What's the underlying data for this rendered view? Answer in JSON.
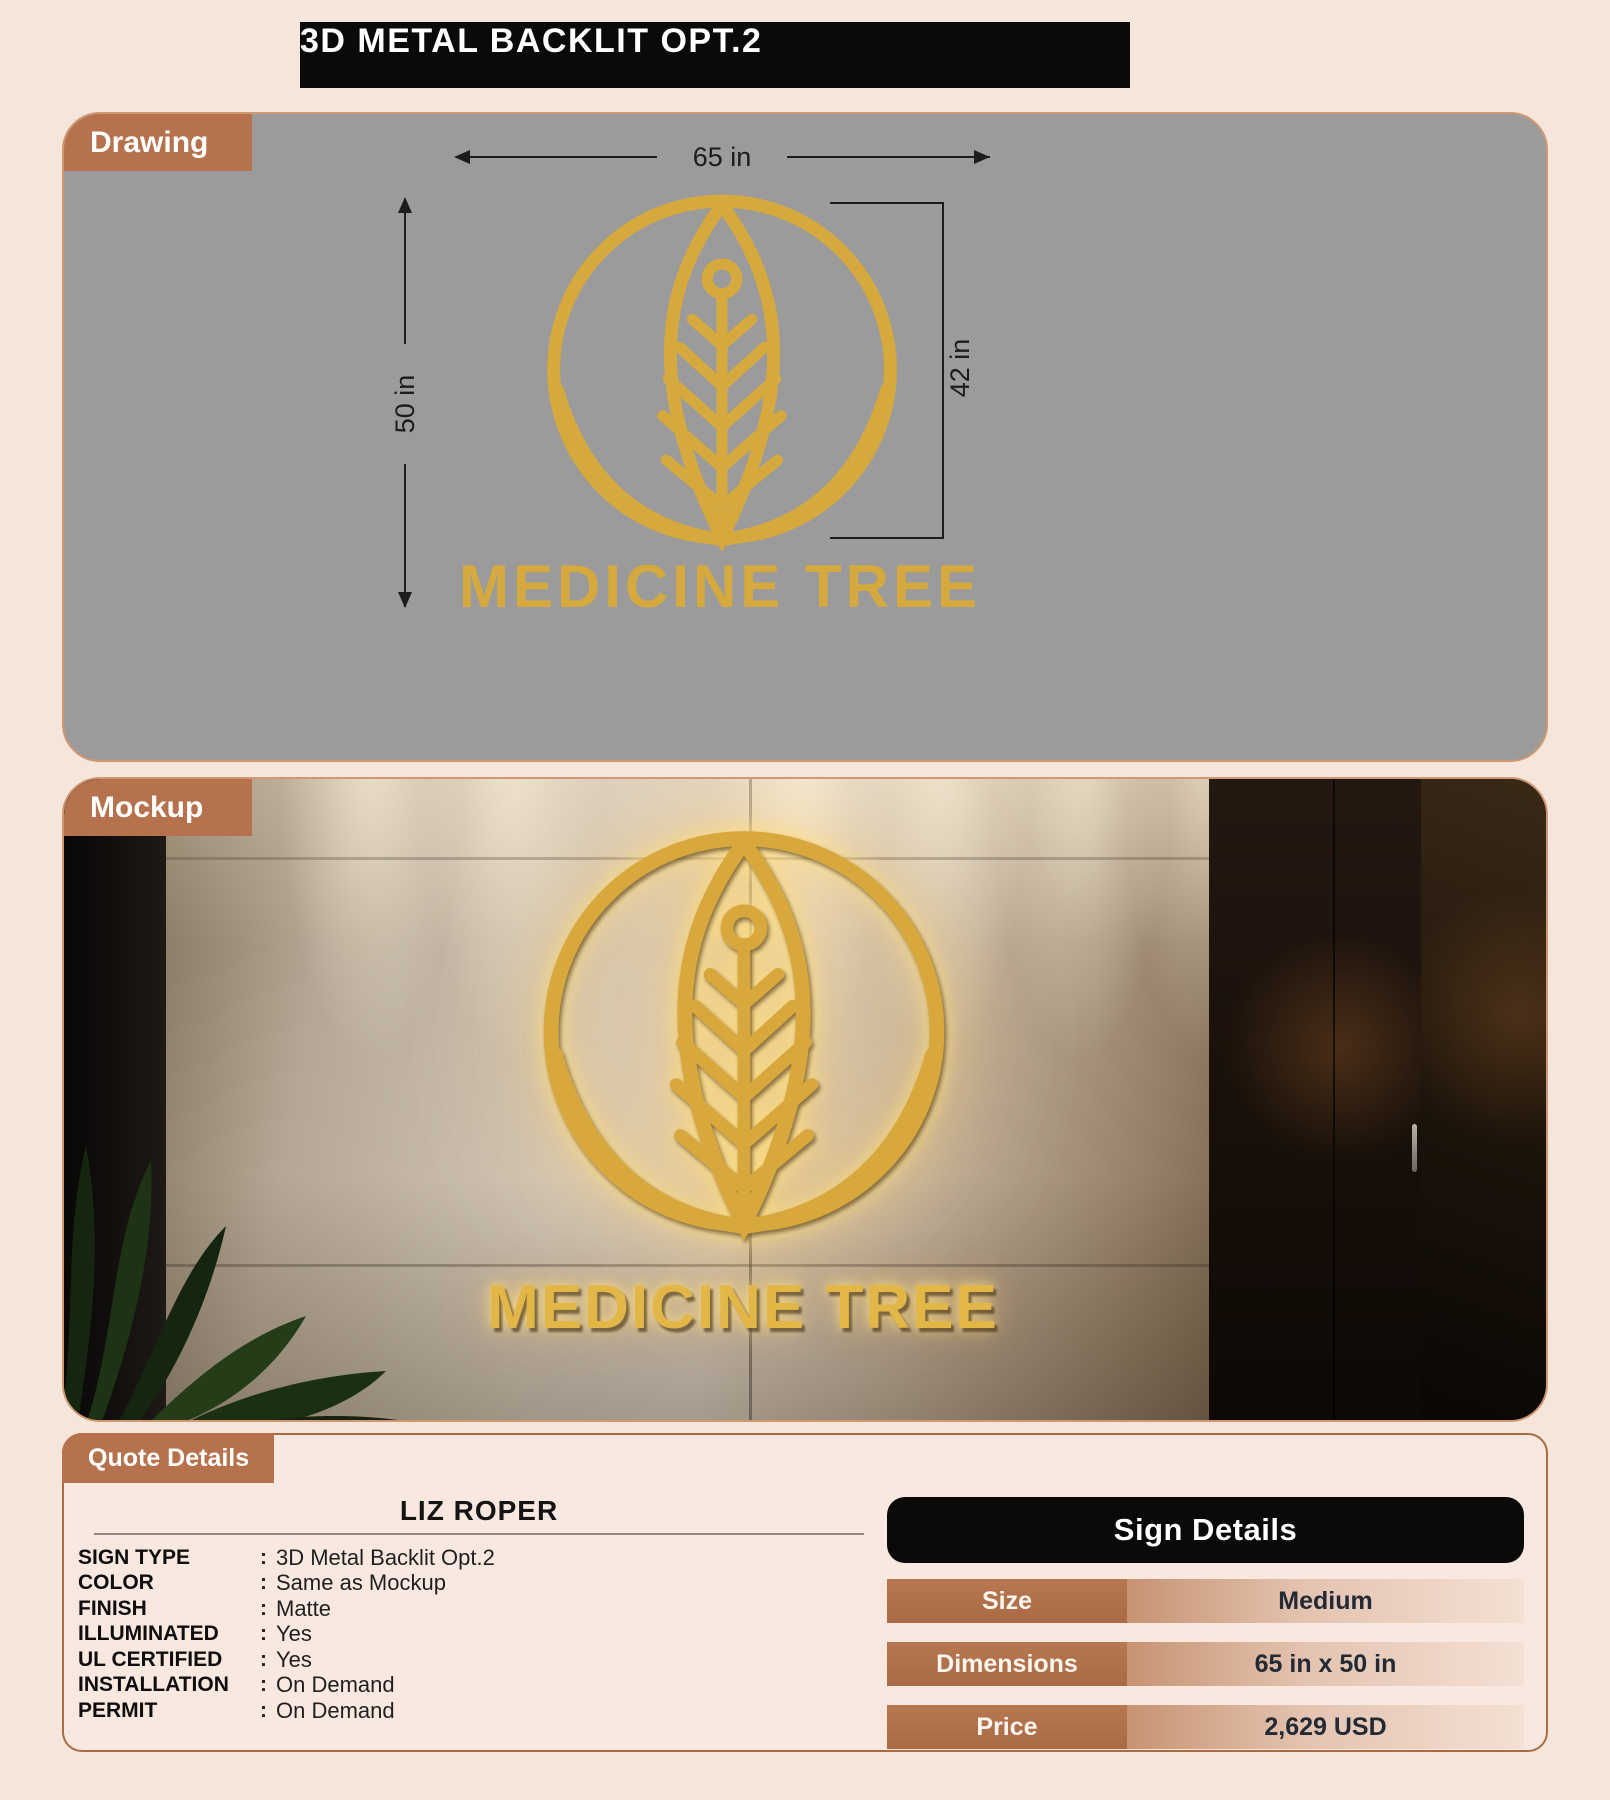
{
  "page": {
    "title": "3D METAL BACKLIT OPT.2",
    "background_color": "#f5e5da",
    "accent_brown": "#b5724d",
    "banner_black": "#0b0a08"
  },
  "drawing": {
    "tab_label": "Drawing",
    "panel_color": "#9b9b9b",
    "gold_color": "#d5a93e",
    "width_label": "65 in",
    "height_label": "50 in",
    "logo_height_label": "42 in",
    "wordmark": "MEDICINE TREE"
  },
  "mockup": {
    "tab_label": "Mockup",
    "glow_gold_color": "#e2b647",
    "wordmark": "MEDICINE TREE"
  },
  "quote": {
    "tab_label": "Quote Details",
    "customer_name": "LIZ ROPER",
    "separator": ":",
    "fields": [
      {
        "label": "SIGN TYPE",
        "value": "3D Metal Backlit Opt.2"
      },
      {
        "label": "COLOR",
        "value": "Same as Mockup"
      },
      {
        "label": "FINISH",
        "value": "Matte"
      },
      {
        "label": "ILLUMINATED",
        "value": "Yes"
      },
      {
        "label": "UL CERTIFIED",
        "value": "Yes"
      },
      {
        "label": "INSTALLATION",
        "value": "On Demand"
      },
      {
        "label": "PERMIT",
        "value": "On Demand"
      }
    ],
    "sign_details": {
      "title": "Sign Details",
      "rows": [
        {
          "label": "Size",
          "value": "Medium"
        },
        {
          "label": "Dimensions",
          "value": "65 in x 50 in"
        },
        {
          "label": "Price",
          "value": "2,629 USD"
        }
      ]
    }
  }
}
